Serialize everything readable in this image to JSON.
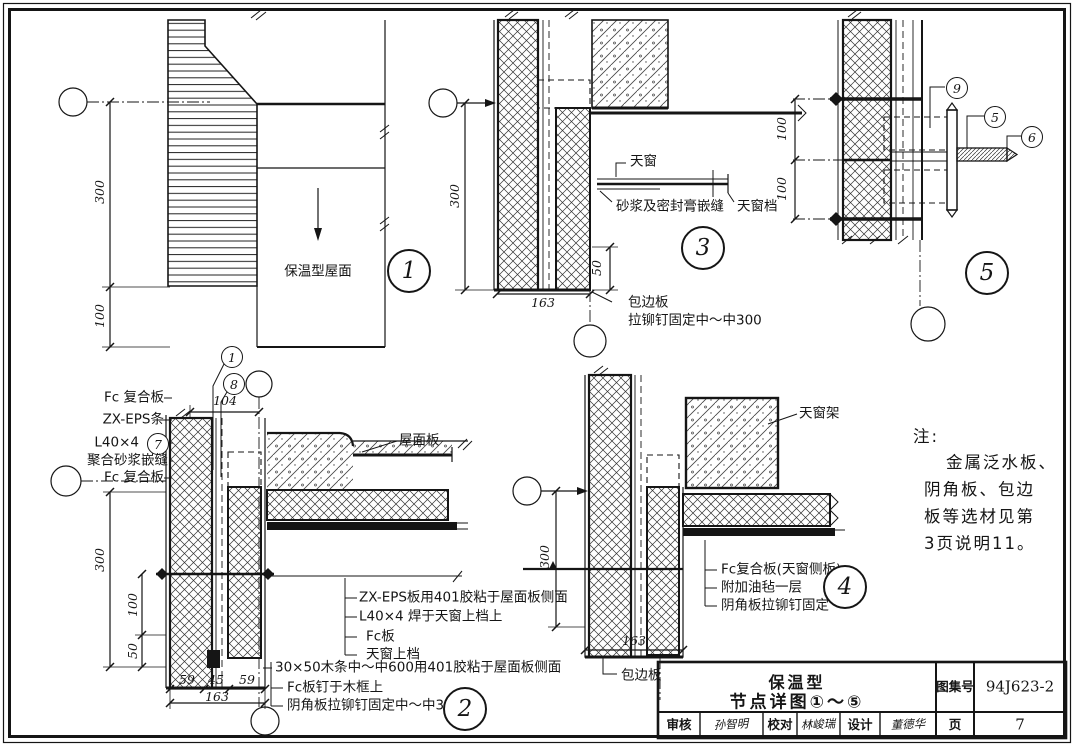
{
  "titleblock": {
    "title_line1": "保温型",
    "title_line2": "节点详图①～⑤",
    "atlas_label": "图集号",
    "atlas_no": "94J623-2",
    "page_label": "页",
    "page_no": "7",
    "audit_label": "审核",
    "audit_sig": "孙智明",
    "check_label": "校对",
    "check_sig": "林峻瑞",
    "design_label": "设计",
    "design_sig": "董德华"
  },
  "note": {
    "head": "注:",
    "line1": "金属泛水板、",
    "line2": "阴角板、包边",
    "line3": "板等选材见第",
    "line4": "3页说明11。"
  },
  "detail1": {
    "num": "1",
    "roof_label": "保温型屋面",
    "dim_300": "300",
    "dim_100": "100"
  },
  "detail2": {
    "num": "2",
    "callout_1": "1",
    "callout_8": "8",
    "callout_7": "7",
    "left_label_1": "Fc 复合板",
    "left_label_2": "ZX-EPS条",
    "left_label_3": "L40×4",
    "left_label_4": "聚合砂浆嵌缝",
    "left_label_5": "Fc 复合板",
    "dim_104": "104",
    "dim_300": "300",
    "dim_100": "100",
    "dim_50": "50",
    "dim_59a": "59",
    "dim_45": "45",
    "dim_59b": "59",
    "dim_163": "163",
    "roof_slab_label": "屋面板",
    "note_1": "ZX-EPS板用401胶粘于屋面板侧面",
    "note_2": "L40×4 焊于天窗上档上",
    "note_3": "Fc板",
    "note_4": "天窗上档",
    "note_5": "30×50木条中～中600用401胶粘于屋面板侧面",
    "note_6": "Fc板钉于木框上",
    "note_7": "阴角板拉铆钉固定中～中300"
  },
  "detail3": {
    "num": "3",
    "skylight_label": "天窗",
    "sealant_label": "砂浆及密封膏嵌缝",
    "stop_label": "天窗档",
    "edge_label_1": "包边板",
    "edge_label_2": "拉铆钉固定中～中300",
    "dim_300": "300",
    "dim_163": "163",
    "dim_50": "50"
  },
  "detail4": {
    "num": "4",
    "frame_label": "天窗架",
    "note_1": "Fc复合板(天窗侧板)",
    "note_2": "附加油毡一层",
    "note_3": "阴角板拉铆钉固定",
    "edge_label": "包边板",
    "dim_300": "300",
    "dim_163": "163"
  },
  "detail5": {
    "num": "5",
    "callout_9": "9",
    "callout_5": "5",
    "callout_6": "6",
    "dim_100a": "100",
    "dim_100b": "100"
  }
}
